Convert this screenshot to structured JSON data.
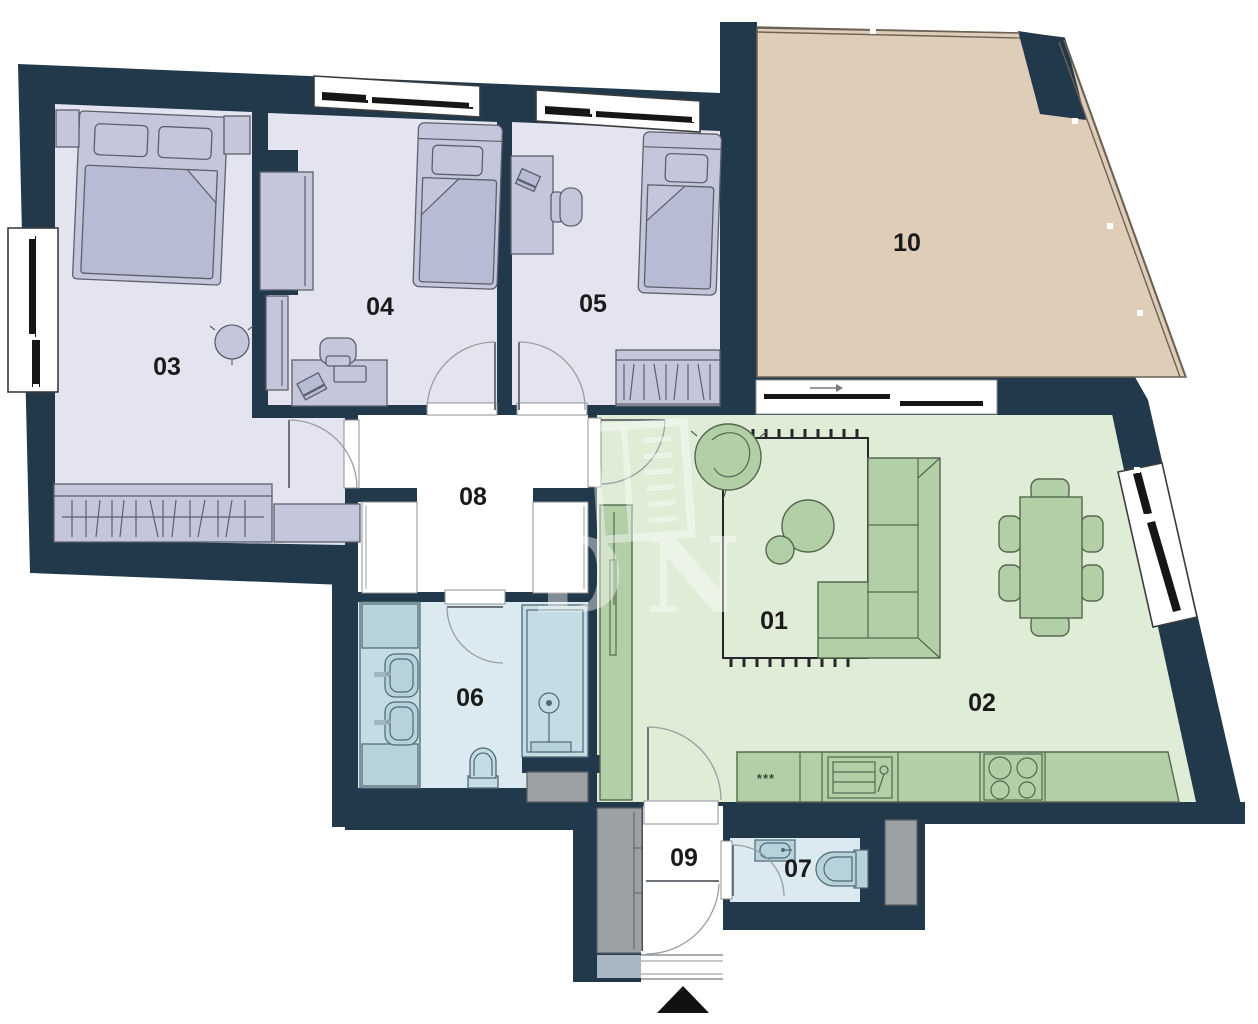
{
  "plan_type": "apartment-floor-plan",
  "rooms": {
    "r01": {
      "label": "01"
    },
    "r02": {
      "label": "02"
    },
    "r03": {
      "label": "03"
    },
    "r04": {
      "label": "04"
    },
    "r05": {
      "label": "05"
    },
    "r06": {
      "label": "06"
    },
    "r07": {
      "label": "07"
    },
    "r08": {
      "label": "08"
    },
    "r09": {
      "label": "09"
    },
    "r10": {
      "label": "10"
    }
  },
  "kitchen": {
    "dishwasher_marks": "***"
  },
  "watermark": {
    "text": "DN"
  },
  "icons": {
    "entrance_marker": "triangle-up",
    "terrace_door_arrow": "arrow-right"
  },
  "colors": {
    "wall": "#21394b",
    "bedroom_floor": "#e3e4ef",
    "bedroom_furniture": "#c4c7db",
    "bedroom_furniture_dark": "#b7bbd4",
    "furn_outline": "#5e5f6b",
    "terrace_floor": "#ddcdb9",
    "terrace_outline": "#6c6154",
    "living_floor": "#dfecd6",
    "green_furniture": "#b2cfa8",
    "green_outline": "#55684e",
    "bath_floor": "#dbeaf0",
    "bath_fixture": "#c5dce4",
    "bath_fixture_dark": "#b7d2da",
    "bath_outline": "#4e6874",
    "hall_floor": "#ffffff",
    "shaft_gray": "#9ba1a5",
    "shaft_bluegray": "#a9b6c3",
    "window_black": "#161616",
    "label": "#1a1a1a"
  }
}
